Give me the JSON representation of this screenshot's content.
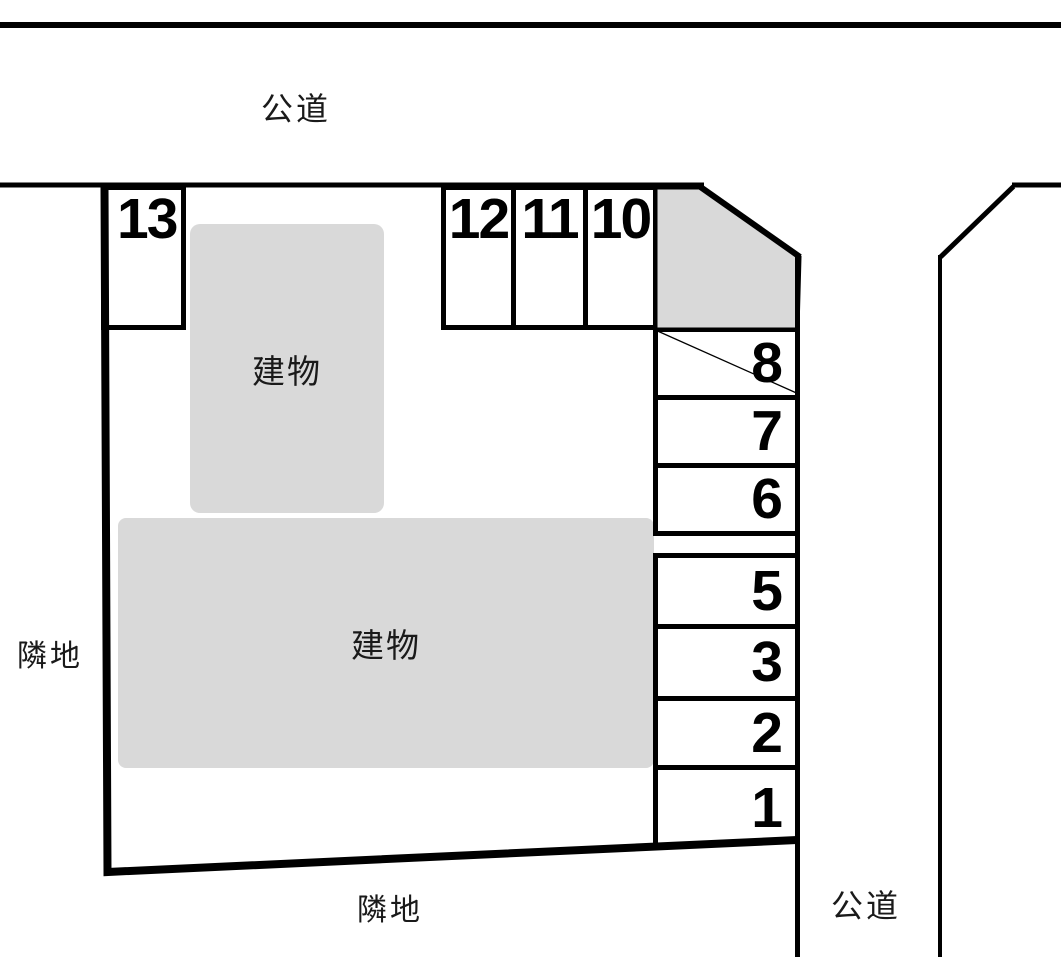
{
  "diagram": {
    "type": "parking-lot-layout",
    "roads": {
      "top": "公道",
      "right": "公道"
    },
    "neighbors": {
      "left": "隣地",
      "bottom": "隣地"
    },
    "buildings": {
      "upper": "建物",
      "lower": "建物"
    },
    "spaces": {
      "s13": "13",
      "s12": "12",
      "s11": "11",
      "s10": "10",
      "s8": "8",
      "s7": "7",
      "s6": "6",
      "s5": "5",
      "s3": "3",
      "s2": "2",
      "s1": "1"
    },
    "colors": {
      "line": "#000000",
      "building_fill": "#d9d9d9",
      "background": "#ffffff"
    }
  }
}
